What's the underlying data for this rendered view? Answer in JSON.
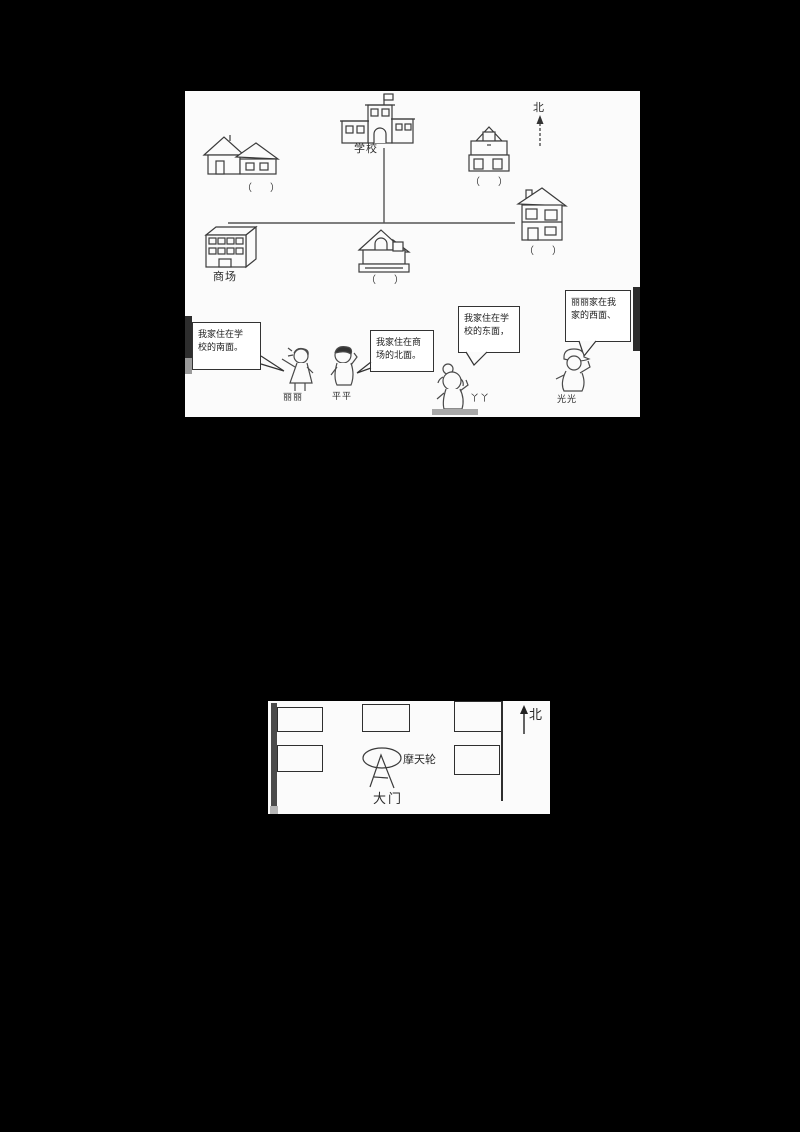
{
  "page": {
    "background": "#000000",
    "paper": "#fbfbfb"
  },
  "top_map": {
    "north_label": "北",
    "school_label": "学校",
    "mall_label": "商场",
    "blank_label": "（　）",
    "bubbles": [
      {
        "line1": "我家住在学",
        "line2": "校的南面。"
      },
      {
        "line1": "我家住在商",
        "line2": "场的北面。"
      },
      {
        "line1": "我家住在学",
        "line2": "校的东面，"
      },
      {
        "line1": "丽丽家在我",
        "line2": "家的西面、"
      }
    ],
    "children": [
      {
        "name": "丽丽"
      },
      {
        "name": "平平"
      },
      {
        "name": "丫丫"
      },
      {
        "name": "光光"
      }
    ]
  },
  "bottom_map": {
    "north_label": "北",
    "ferris_label": "摩天轮",
    "gate_label": "大门"
  }
}
